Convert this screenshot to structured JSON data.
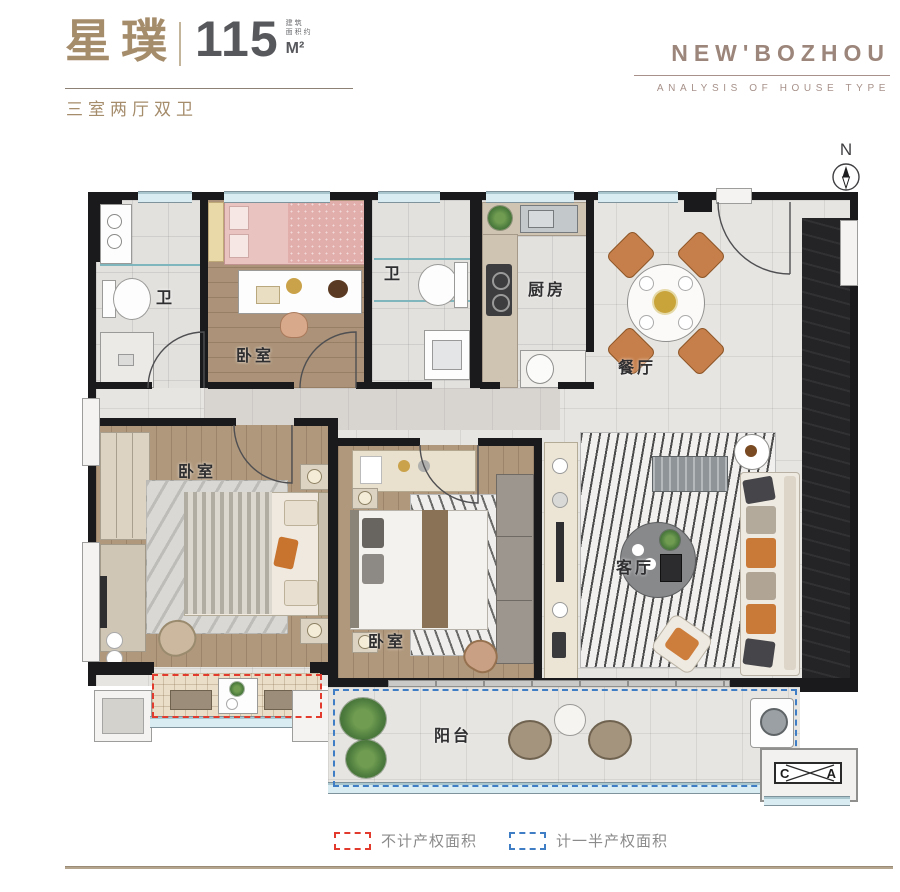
{
  "header": {
    "title": "星璞",
    "area_value": "115",
    "area_note_top": "建筑",
    "area_note_bottom": "面积约",
    "area_unit": "M²",
    "subtitle": "三室两厅双卫"
  },
  "brand": {
    "name": "NEW'BOZHOU",
    "tagline": "ANALYSIS OF HOUSE TYPE"
  },
  "compass": {
    "label": "N"
  },
  "rooms": {
    "bath_top_left": "卫",
    "bedroom_top": "卧室",
    "bath_top_mid": "卫",
    "kitchen": "厨房",
    "dining": "餐厅",
    "bedroom_master": "卧室",
    "bedroom_middle": "卧室",
    "living": "客厅",
    "balcony": "阳台"
  },
  "ac_marker": {
    "left": "C",
    "right": "A"
  },
  "legend": {
    "items": [
      {
        "label": "不计产权面积",
        "color": "#e23b2e"
      },
      {
        "label": "计一半产权面积",
        "color": "#3f7dc4"
      }
    ]
  },
  "colors": {
    "accent": "#a58c6b",
    "brand": "#9c857a",
    "wall": "#1a1a1c",
    "legend_red": "#e23b2e",
    "legend_blue": "#3f7dc4"
  }
}
